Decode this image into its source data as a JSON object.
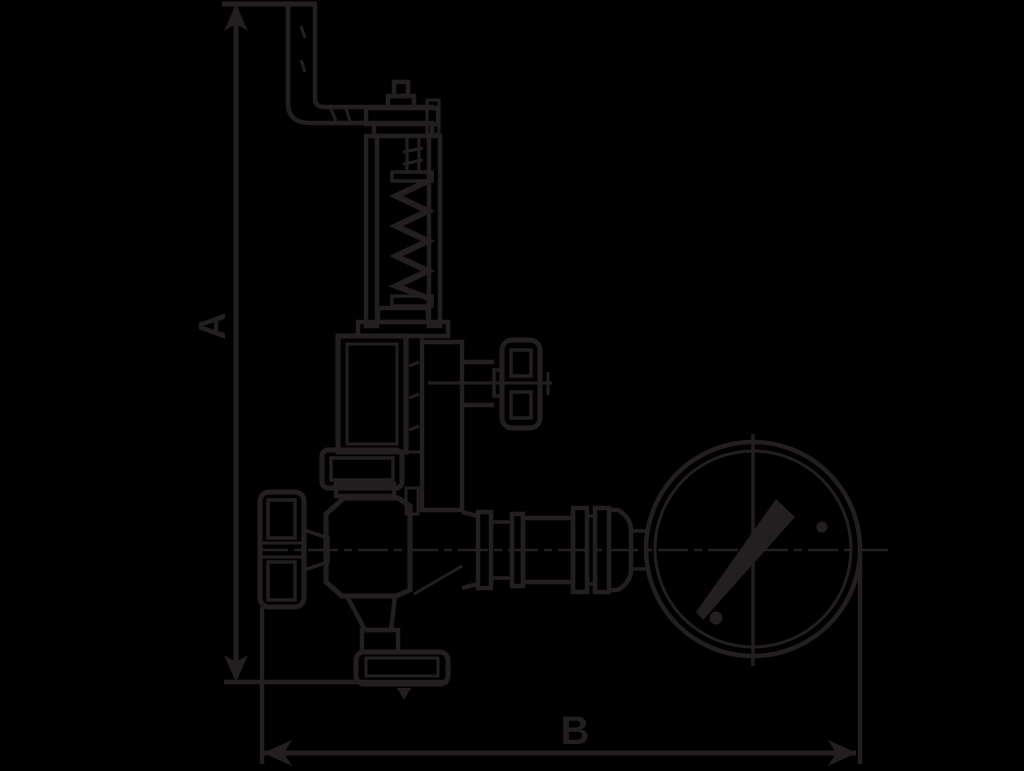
{
  "canvas": {
    "width": 1024,
    "height": 766,
    "background": "#000000",
    "ink": "#231f20"
  },
  "dimension_labels": {
    "vertical": "A",
    "horizontal": "B"
  },
  "components": [
    "release-lever",
    "spindle-tip",
    "spring-housing-cap",
    "yoke-posts",
    "compression-spring",
    "bonnet",
    "test-knob",
    "gland-nut",
    "valve-body",
    "handwheel",
    "outlet-flange",
    "pipe-union",
    "reducer-fitting",
    "pressure-gauge",
    "gauge-needle"
  ]
}
